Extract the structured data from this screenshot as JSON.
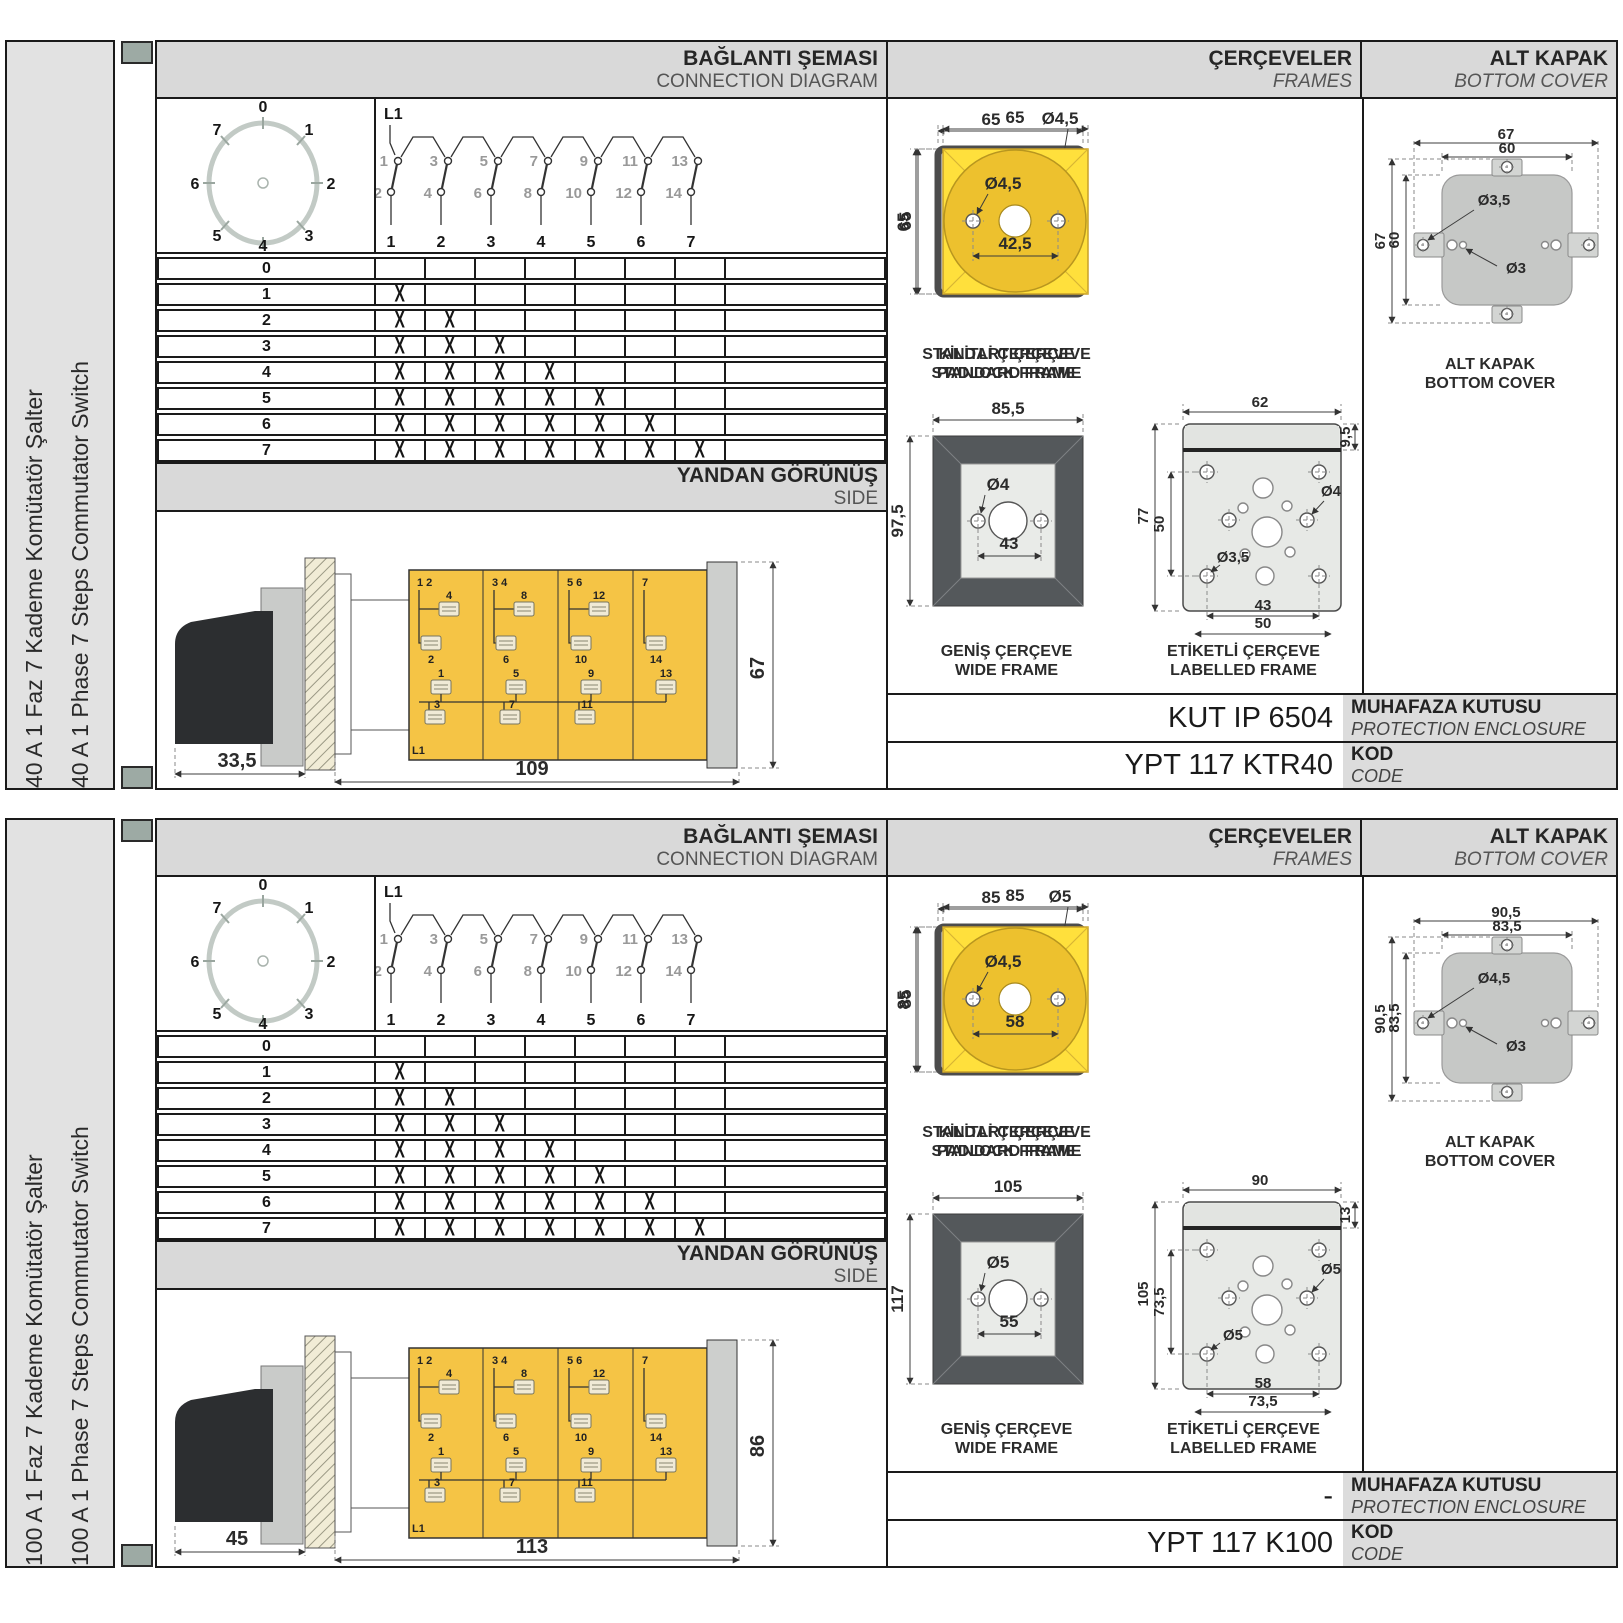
{
  "sections": [
    {
      "product_tr": "40 A 1 Faz 7 Kademe Komütatör Şalter",
      "product_en": "40 A 1 Phase 7 Steps Commutator Switch",
      "headers": {
        "conn_tr": "BAĞLANTI ŞEMASI",
        "conn_en": "CONNECTION DIAGRAM",
        "frames_tr": "ÇERÇEVELER",
        "frames_en": "FRAMES",
        "cover_tr": "ALT KAPAK",
        "cover_en": "BOTTOM COVER",
        "side_tr": "YANDAN GÖRÜNÜŞ",
        "side_en": "SIDE"
      },
      "dial": [
        "0",
        "1",
        "2",
        "3",
        "4",
        "5",
        "6",
        "7"
      ],
      "schematic": {
        "feed": "L1",
        "upper": [
          "1",
          "3",
          "5",
          "7",
          "9",
          "11",
          "13"
        ],
        "lower": [
          "2",
          "4",
          "6",
          "8",
          "10",
          "12",
          "14"
        ],
        "cols": [
          "1",
          "2",
          "3",
          "4",
          "5",
          "6",
          "7"
        ]
      },
      "table": {
        "rows": [
          {
            "step": "0",
            "cells": [
              "",
              "",
              "",
              "",
              "",
              "",
              ""
            ]
          },
          {
            "step": "1",
            "cells": [
              "X",
              "",
              "",
              "",
              "",
              "",
              ""
            ]
          },
          {
            "step": "2",
            "cells": [
              "X",
              "X",
              "",
              "",
              "",
              "",
              ""
            ]
          },
          {
            "step": "3",
            "cells": [
              "X",
              "X",
              "X",
              "",
              "",
              "",
              ""
            ]
          },
          {
            "step": "4",
            "cells": [
              "X",
              "X",
              "X",
              "X",
              "",
              "",
              ""
            ]
          },
          {
            "step": "5",
            "cells": [
              "X",
              "X",
              "X",
              "X",
              "X",
              "",
              ""
            ]
          },
          {
            "step": "6",
            "cells": [
              "X",
              "X",
              "X",
              "X",
              "X",
              "X",
              ""
            ]
          },
          {
            "step": "7",
            "cells": [
              "X",
              "X",
              "X",
              "X",
              "X",
              "X",
              "X"
            ]
          }
        ]
      },
      "side_view": {
        "feed": "L1",
        "dim_handle": "33,5",
        "dim_length": "109",
        "dim_height": "67",
        "groups": [
          "1 2",
          "3 4",
          "5 6",
          "7"
        ],
        "top_upper": [
          "4",
          "8",
          "12"
        ],
        "top_lower": [
          "2",
          "6",
          "10",
          "14"
        ],
        "bot_upper": [
          "1",
          "5",
          "9",
          "13"
        ],
        "bot_lower": [
          "3",
          "7",
          "11"
        ]
      },
      "frames": {
        "standard": {
          "tr": "STANDART ÇERÇEVE",
          "en": "STANDARD FRAME",
          "w": "65",
          "h": "65",
          "hole": "Ø4,5",
          "pitch": "50"
        },
        "padlock": {
          "tr": "KİLİTLİ ÇERÇEVE",
          "en": "PADLOCK FRAME",
          "w": "65",
          "h": "65",
          "hole": "Ø4,5",
          "pitch": "42,5"
        },
        "wide": {
          "tr": "GENİŞ ÇERÇEVE",
          "en": "WIDE FRAME",
          "w": "85,5",
          "h": "97,5",
          "hole": "Ø4",
          "pitch": "43"
        },
        "labelled": {
          "tr": "ETİKETLİ ÇERÇEVE",
          "en": "LABELLED FRAME",
          "w": "62",
          "strip": "9,5",
          "h_outer": "77",
          "h_inner": "50",
          "hole_right": "Ø4",
          "hole_left": "Ø3,5",
          "w_inner": "43",
          "w_outer": "50"
        }
      },
      "cover": {
        "tr": "ALT KAPAK",
        "en": "BOTTOM COVER",
        "w_outer": "67",
        "w_inner": "60",
        "h_outer": "67",
        "h_inner": "60",
        "hole_tab": "Ø3,5",
        "hole_small": "Ø3"
      },
      "codes": {
        "enclosure": "KUT IP 6504",
        "enclosure_tr": "MUHAFAZA KUTUSU",
        "enclosure_en": "PROTECTION ENCLOSURE",
        "code": "YPT 117 KTR40",
        "code_tr": "KOD",
        "code_en": "CODE"
      }
    },
    {
      "product_tr": "100 A 1 Faz 7 Kademe Komütatör Şalter",
      "product_en": "100 A 1 Phase 7 Steps Commutator Switch",
      "headers": {
        "conn_tr": "BAĞLANTI ŞEMASI",
        "conn_en": "CONNECTION DIAGRAM",
        "frames_tr": "ÇERÇEVELER",
        "frames_en": "FRAMES",
        "cover_tr": "ALT KAPAK",
        "cover_en": "BOTTOM COVER",
        "side_tr": "YANDAN GÖRÜNÜŞ",
        "side_en": "SIDE"
      },
      "dial": [
        "0",
        "1",
        "2",
        "3",
        "4",
        "5",
        "6",
        "7"
      ],
      "schematic": {
        "feed": "L1",
        "upper": [
          "1",
          "3",
          "5",
          "7",
          "9",
          "11",
          "13"
        ],
        "lower": [
          "2",
          "4",
          "6",
          "8",
          "10",
          "12",
          "14"
        ],
        "cols": [
          "1",
          "2",
          "3",
          "4",
          "5",
          "6",
          "7"
        ]
      },
      "table": {
        "rows": [
          {
            "step": "0",
            "cells": [
              "",
              "",
              "",
              "",
              "",
              "",
              ""
            ]
          },
          {
            "step": "1",
            "cells": [
              "X",
              "",
              "",
              "",
              "",
              "",
              ""
            ]
          },
          {
            "step": "2",
            "cells": [
              "X",
              "X",
              "",
              "",
              "",
              "",
              ""
            ]
          },
          {
            "step": "3",
            "cells": [
              "X",
              "X",
              "X",
              "",
              "",
              "",
              ""
            ]
          },
          {
            "step": "4",
            "cells": [
              "X",
              "X",
              "X",
              "X",
              "",
              "",
              ""
            ]
          },
          {
            "step": "5",
            "cells": [
              "X",
              "X",
              "X",
              "X",
              "X",
              "",
              ""
            ]
          },
          {
            "step": "6",
            "cells": [
              "X",
              "X",
              "X",
              "X",
              "X",
              "X",
              ""
            ]
          },
          {
            "step": "7",
            "cells": [
              "X",
              "X",
              "X",
              "X",
              "X",
              "X",
              "X"
            ]
          }
        ]
      },
      "side_view": {
        "feed": "L1",
        "dim_handle": "45",
        "dim_length": "113",
        "dim_height": "86",
        "groups": [
          "1 2",
          "3 4",
          "5 6",
          "7"
        ],
        "top_upper": [
          "4",
          "8",
          "12"
        ],
        "top_lower": [
          "2",
          "6",
          "10",
          "14"
        ],
        "bot_upper": [
          "1",
          "5",
          "9",
          "13"
        ],
        "bot_lower": [
          "3",
          "7",
          "11"
        ]
      },
      "frames": {
        "standard": {
          "tr": "STANDART ÇERÇEVE",
          "en": "STANDARD FRAME",
          "w": "85",
          "h": "85",
          "hole": "Ø5",
          "pitch": "65"
        },
        "padlock": {
          "tr": "KİLİTLİ ÇERÇEVE",
          "en": "PADLOCK FRAME",
          "w": "85",
          "h": "85",
          "hole": "Ø4,5",
          "pitch": "58"
        },
        "wide": {
          "tr": "GENİŞ ÇERÇEVE",
          "en": "WIDE FRAME",
          "w": "105",
          "h": "117",
          "hole": "Ø5",
          "pitch": "55"
        },
        "labelled": {
          "tr": "ETİKETLİ ÇERÇEVE",
          "en": "LABELLED FRAME",
          "w": "90",
          "strip": "13",
          "h_outer": "105",
          "h_inner": "73,5",
          "hole_right": "Ø5",
          "hole_left": "Ø5",
          "w_inner": "58",
          "w_outer": "73,5"
        }
      },
      "cover": {
        "tr": "ALT KAPAK",
        "en": "BOTTOM COVER",
        "w_outer": "90,5",
        "w_inner": "83,5",
        "h_outer": "90,5",
        "h_inner": "83,5",
        "hole_tab": "Ø4,5",
        "hole_small": "Ø3"
      },
      "codes": {
        "enclosure": "-",
        "enclosure_tr": "MUHAFAZA KUTUSU",
        "enclosure_en": "PROTECTION ENCLOSURE",
        "code": "YPT 117 K100",
        "code_tr": "KOD",
        "code_en": "CODE"
      }
    }
  ]
}
